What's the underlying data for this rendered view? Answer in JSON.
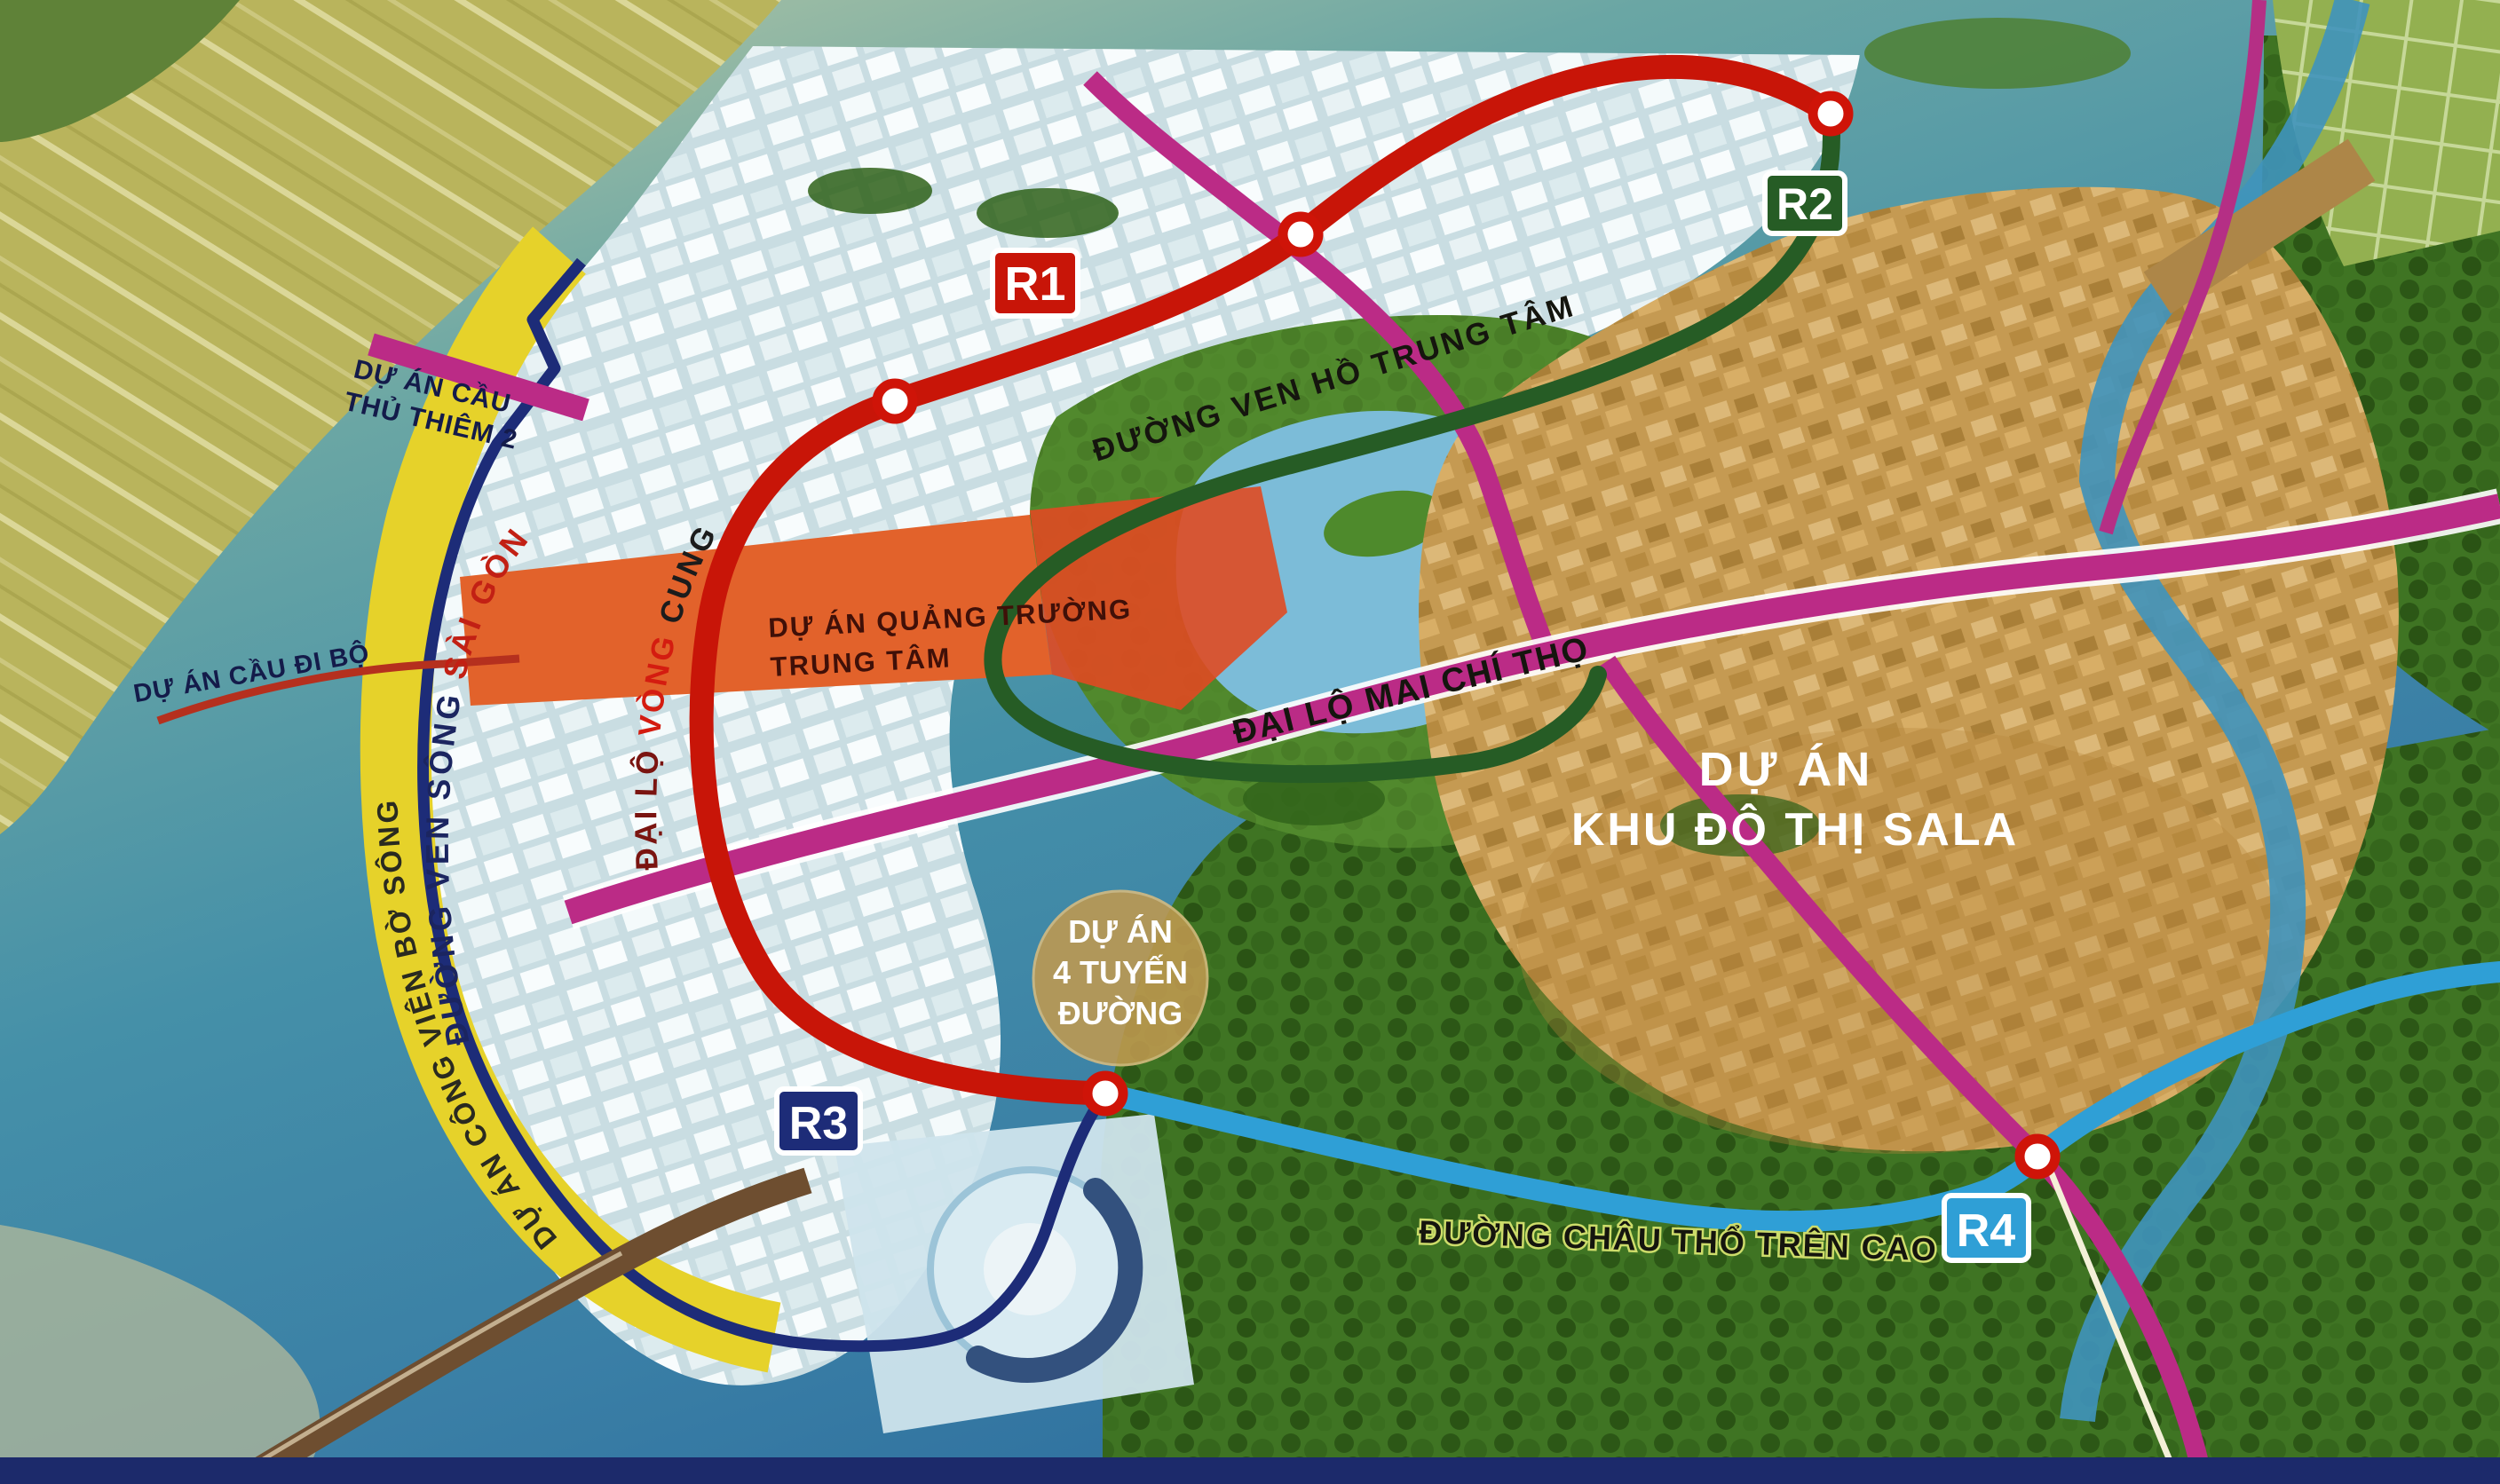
{
  "map": {
    "routes": {
      "r1": {
        "badge": "R1",
        "color": "#c81508"
      },
      "r2": {
        "badge": "R2",
        "color": "#265c25"
      },
      "r3": {
        "badge": "R3",
        "color": "#1d2c78"
      },
      "r4": {
        "badge": "R4",
        "color": "#2f9fd6"
      }
    },
    "road_labels": {
      "ven_ho": "ĐƯỜNG VEN HỒ TRUNG TÂM",
      "mai_chi_tho": "ĐẠI LỘ MAI CHÍ THỌ",
      "chau_tho": "ĐƯỜNG CHÂU THỔ TRÊN CAO",
      "vong_cung_p1": "ĐẠI LỘ ",
      "vong_cung_p2": "VÒNG ",
      "vong_cung_p3": "CUNG",
      "ven_song_p1": "ĐƯỜNG VEN SÔNG ",
      "ven_song_p2": "SÀI GÒN"
    },
    "projects": {
      "cau_thu_thiem2_l1": "DỰ ÁN CẦU",
      "cau_thu_thiem2_l2": "THỦ THIÊM 2",
      "cau_di_bo": "DỰ ÁN CẦU ĐI BỘ",
      "cong_vien_bo_song": "DỰ ÁN CÔNG VIÊN BỜ SÔNG",
      "quang_truong_l1": "DỰ ÁN QUẢNG TRƯỜNG",
      "quang_truong_l2": "TRUNG TÂM",
      "sala_l1": "DỰ ÁN",
      "sala_l2": "KHU ĐÔ THỊ SALA",
      "bon_tuyen_l1": "DỰ ÁN",
      "bon_tuyen_l2": "4 TUYẾN",
      "bon_tuyen_l3": "ĐƯỜNG"
    },
    "colors": {
      "water": "#3c85a2",
      "riverfront_band": "#e6d22a",
      "ring_border": "#1d2c78",
      "central_square": "#e2622b",
      "mai_chi_tho_road": "#bb2b86",
      "sala_area": "#c59a52",
      "forest": "#3f7423"
    }
  }
}
